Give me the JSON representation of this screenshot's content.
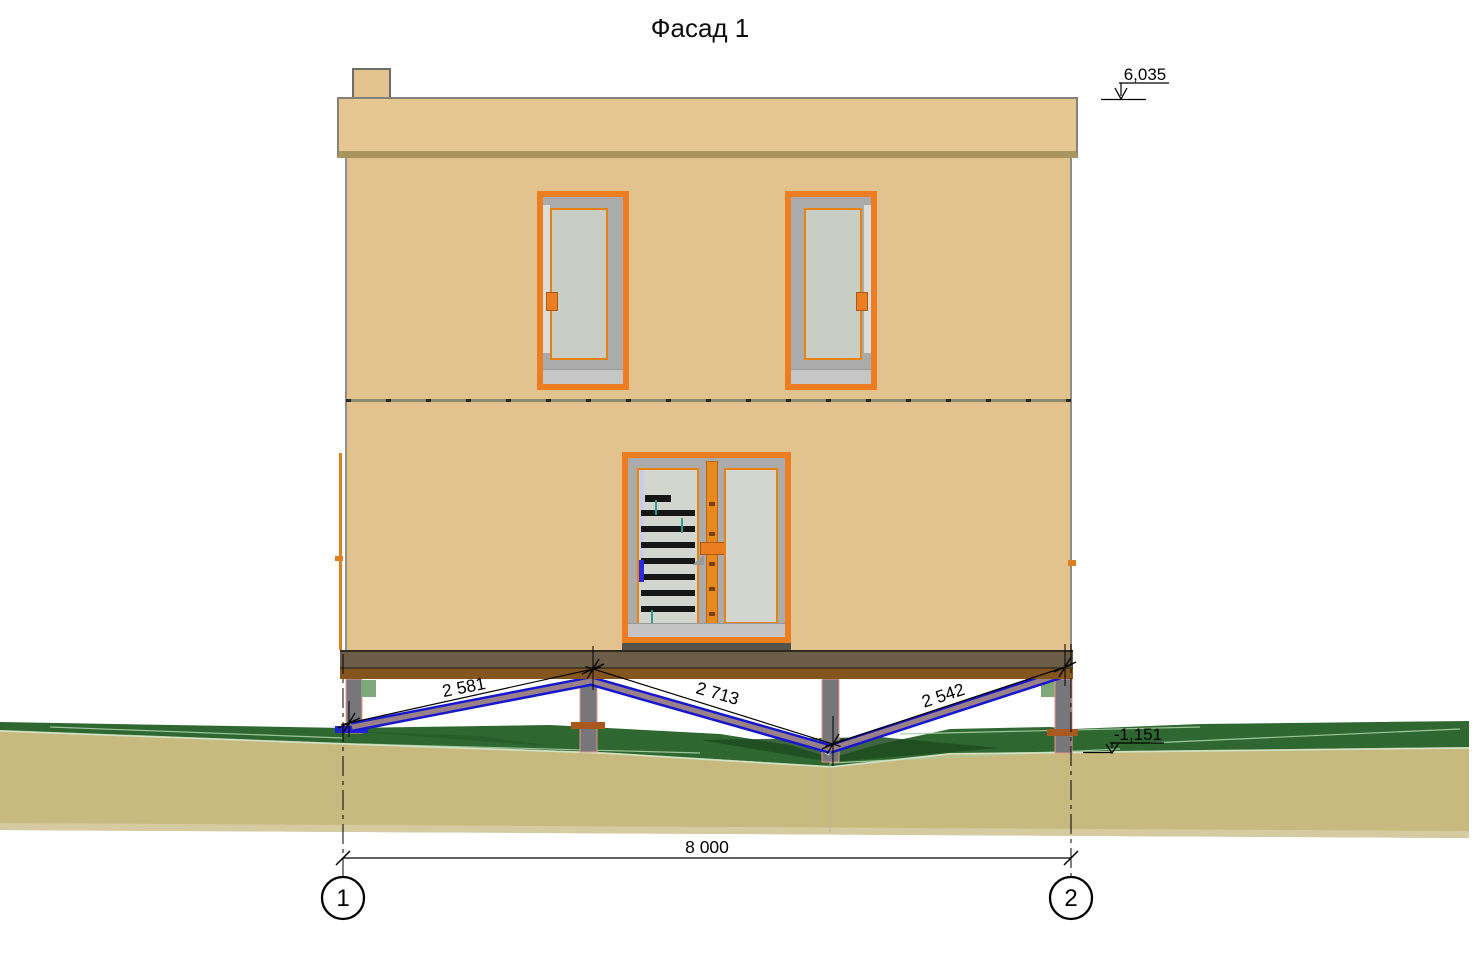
{
  "title": "Фасад 1",
  "elevation_marks": {
    "roof_top": "6,035",
    "ground_level": "-1,151"
  },
  "brace_dimensions": {
    "left": "2 581",
    "middle": "2 713",
    "right": "2 542"
  },
  "overall_dimension": "8 000",
  "axis_markers": {
    "left": "1",
    "right": "2"
  },
  "colors": {
    "wall": "#e2c38d",
    "parapet": "#e6c791",
    "frame_orange": "#ed7d21",
    "glass": "#c9cec5",
    "foundation_upper": "#6b5d48",
    "foundation_lower": "#84561d",
    "pile_gray": "#77767a",
    "brace_blue": "#1717cf",
    "grass_green": "#2e6830",
    "soil_tan": "#c8b97e"
  }
}
